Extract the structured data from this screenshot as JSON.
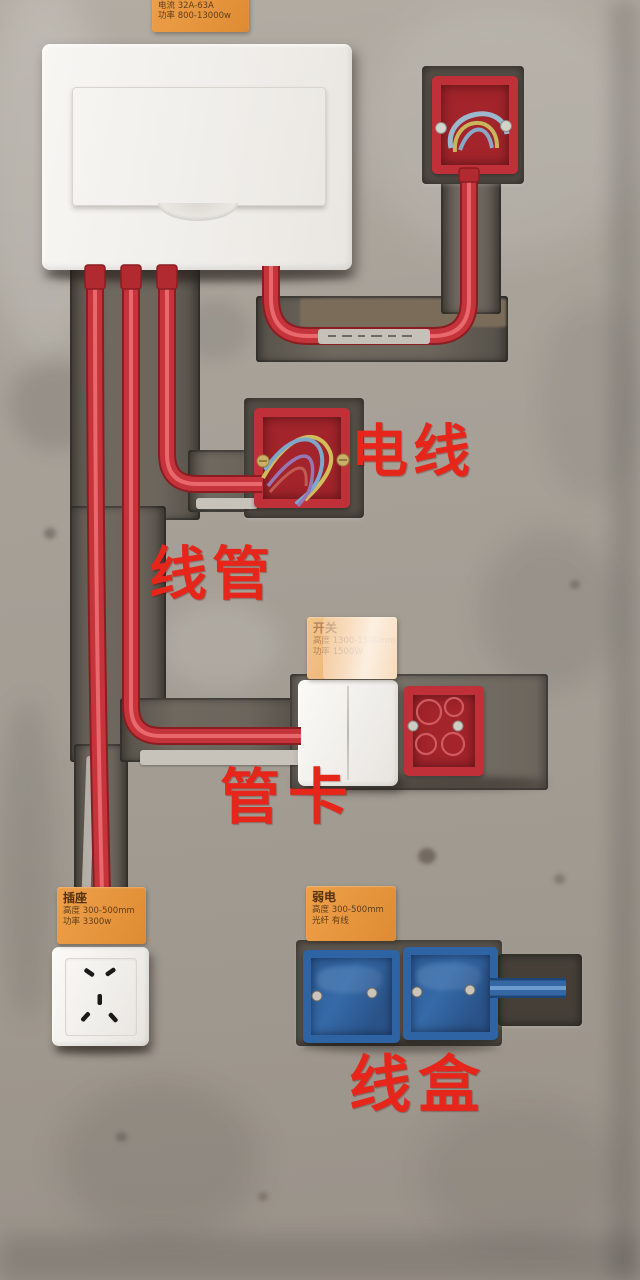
{
  "annotations": {
    "wire": "电线",
    "conduit": "线管",
    "clamp": "管卡",
    "junction_box": "线盒"
  },
  "info_labels": {
    "distribution": {
      "line1": "高度 1500-1800mm",
      "line2": "电流 32A-63A",
      "line3": "功率 800-13000w"
    },
    "switch": {
      "title": "开关",
      "line1": "高度 1300-1500mm",
      "line2": "功率 1500W"
    },
    "socket": {
      "title": "插座",
      "line1": "高度 300-500mm",
      "line2": "功率 3300w"
    },
    "weak_current": {
      "title": "弱电",
      "line1": "高度 300-500mm",
      "line2": "光纤 有线"
    }
  },
  "colors": {
    "conduit_red": "#c5343a",
    "box_red": "#bf3038",
    "box_blue": "#2e64a4",
    "label_orange": "#e4923a",
    "annotation_red": "#e6261b",
    "wall_grey": "#a6a098"
  }
}
